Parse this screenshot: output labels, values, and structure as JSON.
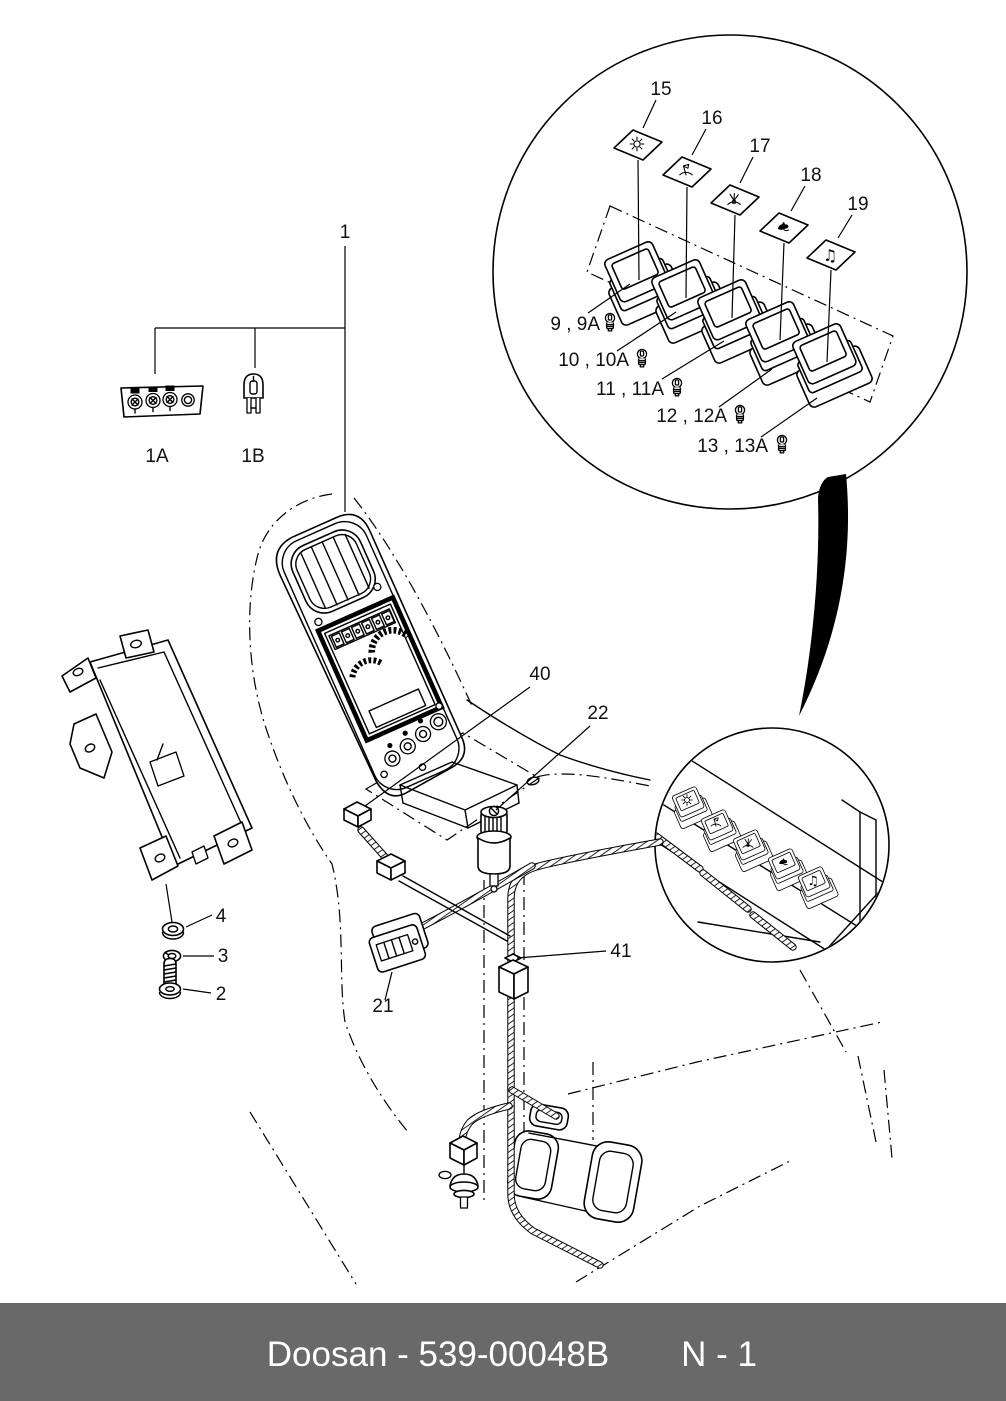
{
  "page": {
    "background": "#ffffff",
    "line_color": "#000000"
  },
  "footer": {
    "left": "Doosan - 539-00048B",
    "right": "N - 1",
    "background": "#696969",
    "text_color": "#ffffff"
  },
  "callouts": {
    "n1": "1",
    "n1a": "1A",
    "n1b": "1B",
    "n2": "2",
    "n3": "3",
    "n4": "4",
    "n9": "9 , 9A",
    "n10": "10 , 10A",
    "n11": "11 , 11A",
    "n12": "12 , 12A",
    "n13": "13 , 13A",
    "n15": "15",
    "n16": "16",
    "n17": "17",
    "n18": "18",
    "n19": "19",
    "n21": "21",
    "n22": "22",
    "n40": "40",
    "n41": "41"
  },
  "icons": {
    "audio_glyph": "♫",
    "plate_icons": [
      "light-icon",
      "wiper-icon",
      "washer-icon",
      "horn-icon",
      "audio-icon"
    ],
    "bulb_icon": "bulb-icon"
  }
}
